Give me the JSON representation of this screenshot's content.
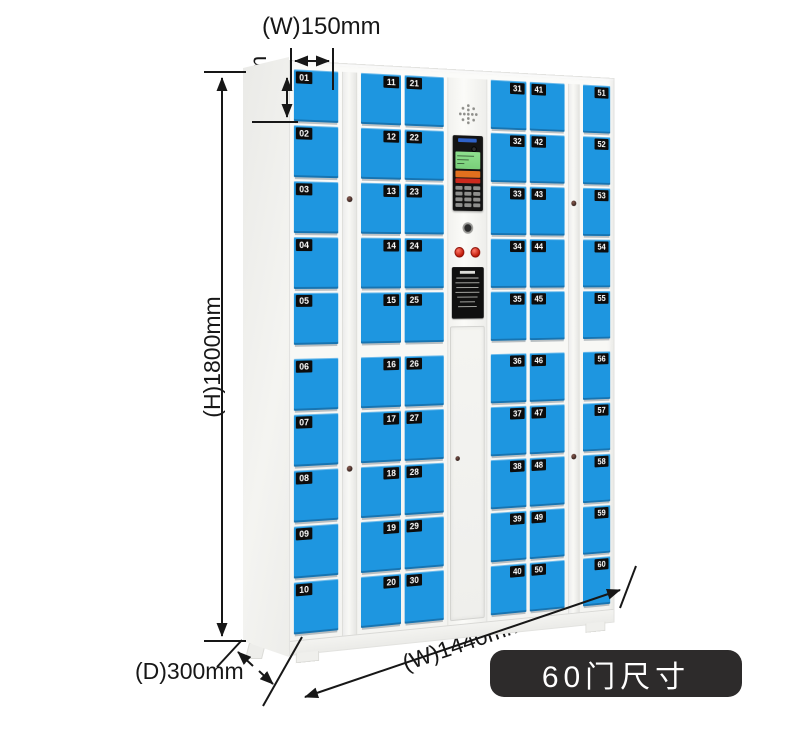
{
  "annotations": {
    "door_width_label": "(W)150mm",
    "door_height_label": "(H)150mm",
    "cabinet_height_label": "(H)1800mm",
    "cabinet_width_label": "(W)1440mm",
    "cabinet_depth_label": "(D)300mm"
  },
  "badge": {
    "label": "60门尺寸",
    "bg_color": "#2d2b2b",
    "text_color": "#ffffff"
  },
  "cabinet": {
    "door_color": "#1e96e0",
    "body_color": "#f6f6f3",
    "plate_color": "#0c0c0c",
    "plate_text_color": "#ffffff",
    "columns": [
      {
        "type": "doors",
        "name": "column-1",
        "number_side": "left",
        "doors": [
          "01",
          "02",
          "03",
          "04",
          "05",
          "06",
          "07",
          "08",
          "09",
          "10"
        ]
      },
      {
        "type": "lock-strip",
        "name": "lock-strip-1"
      },
      {
        "type": "doors",
        "name": "column-2",
        "number_side": "right",
        "doors": [
          "11",
          "12",
          "13",
          "14",
          "15",
          "16",
          "17",
          "18",
          "19",
          "20"
        ]
      },
      {
        "type": "doors",
        "name": "column-3",
        "number_side": "left",
        "doors": [
          "21",
          "22",
          "23",
          "24",
          "25",
          "26",
          "27",
          "28",
          "29",
          "30"
        ]
      },
      {
        "type": "control",
        "name": "control-column"
      },
      {
        "type": "doors",
        "name": "column-4",
        "number_side": "right",
        "doors": [
          "31",
          "32",
          "33",
          "34",
          "35",
          "36",
          "37",
          "38",
          "39",
          "40"
        ]
      },
      {
        "type": "doors",
        "name": "column-5",
        "number_side": "left",
        "doors": [
          "41",
          "42",
          "43",
          "44",
          "45",
          "46",
          "47",
          "48",
          "49",
          "50"
        ]
      },
      {
        "type": "lock-strip",
        "name": "lock-strip-2"
      },
      {
        "type": "doors",
        "name": "column-6",
        "number_side": "right",
        "doors": [
          "51",
          "52",
          "53",
          "54",
          "55",
          "56",
          "57",
          "58",
          "59",
          "60"
        ]
      }
    ]
  },
  "control_panel": {
    "screen_color": "#8fe08f",
    "brand_color": "#2f62c8",
    "button_orange": "#e2701e",
    "button_red": "#cc2a1e",
    "icons": [
      "speaker-icon",
      "camera-icon",
      "lcd-screen",
      "keypad",
      "keyhole-icon",
      "emergency-buttons",
      "instruction-sticker",
      "service-keyhole-icon"
    ]
  }
}
